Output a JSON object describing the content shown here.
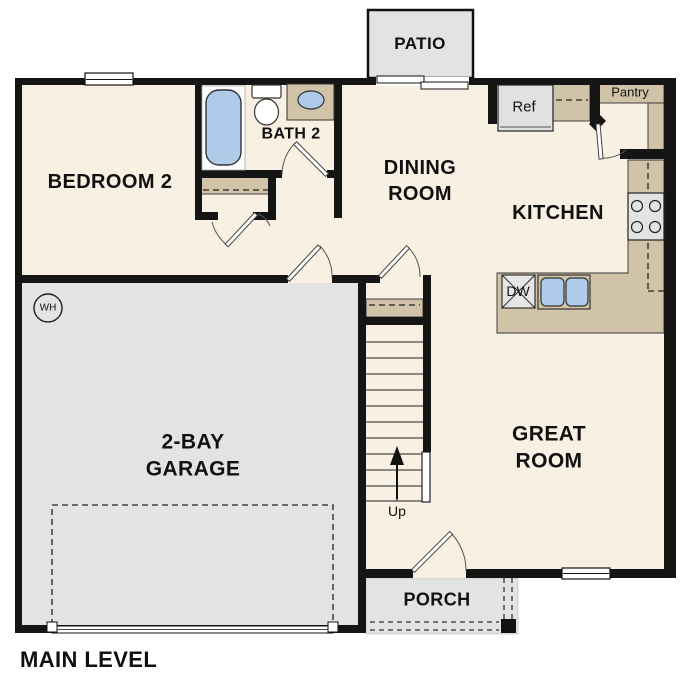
{
  "title": {
    "label": "MAIN LEVEL"
  },
  "rooms": {
    "patio": "PATIO",
    "bedroom2": "BEDROOM 2",
    "bath2": "BATH 2",
    "dining": "DINING\nROOM",
    "kitchen": "KITCHEN",
    "great": "GREAT\nROOM",
    "garage": "2-BAY\nGARAGE",
    "porch": "PORCH"
  },
  "features": {
    "pantry": "Pantry",
    "ref": "Ref",
    "dw": "DW",
    "wh": "WH",
    "stairs_up": "Up"
  },
  "colors": {
    "floor": "#f7f0e3",
    "cabinet_tan": "#d0c3a8",
    "concrete_gray": "#e3e3e3",
    "fixture_blue": "#aecbe9",
    "wall": "#151515"
  }
}
